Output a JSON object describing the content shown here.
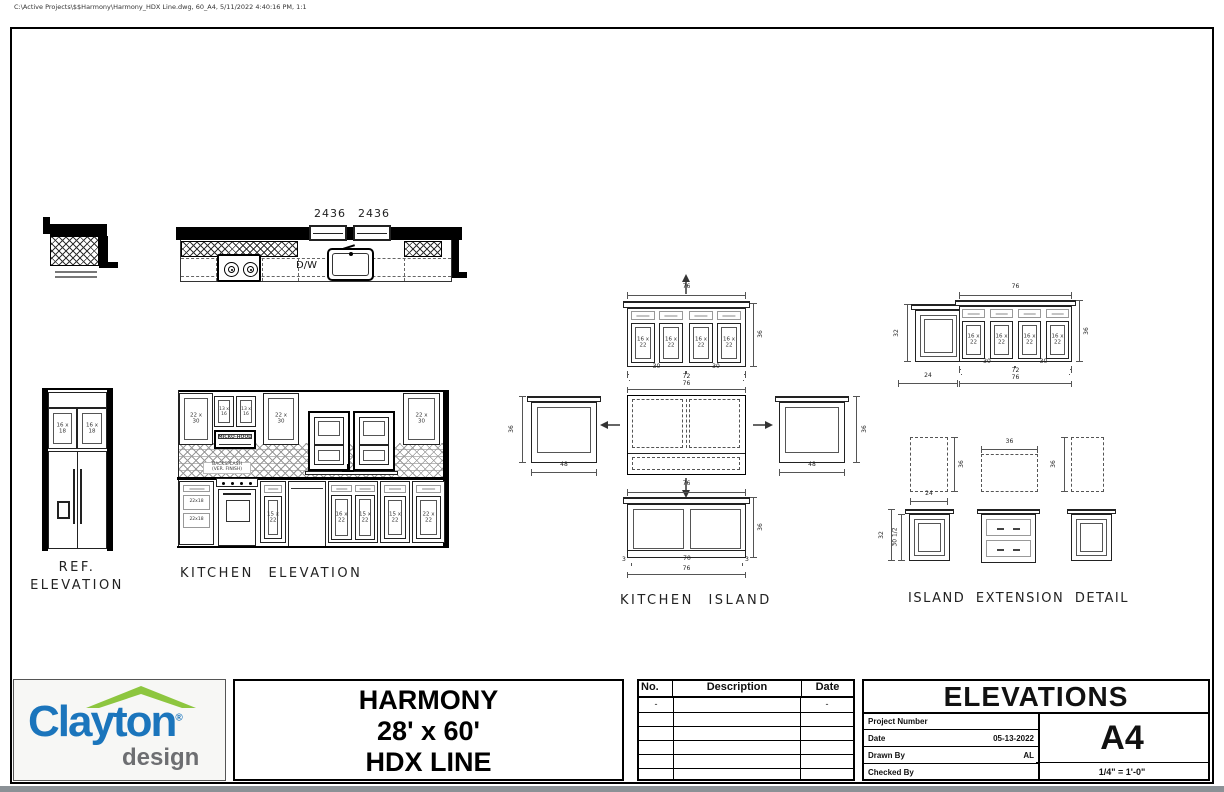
{
  "page": {
    "file_info": "C:\\Active Projects\\$$Harmony\\Harmony_HDX Line.dwg, 60_A4, 5/11/2022 4:40:16 PM, 1:1"
  },
  "colors": {
    "clayton_blue": "#1b75bc",
    "clayton_green": "#8dc63f",
    "design_gray": "#6d6e71"
  },
  "plan": {
    "win1": "2436",
    "win2": "2436",
    "dw": "D/W"
  },
  "ref_elev": {
    "t1": "REF.",
    "t2": "ELEVATION",
    "cab1": "16 x 18",
    "cab2": "16 x 18"
  },
  "kitchen": {
    "title": "KITCHEN ELEVATION",
    "cab_left": "22 x 30",
    "cab_oh1": "13 x 16",
    "cab_oh2": "13 x 16",
    "hood": "MICRO-HOOD",
    "cab_mid": "22 x 30",
    "cab_right": "22 x 30",
    "bs1": "BACKSPLASH",
    "bs2": "(VER. FINISH)",
    "dr1": "22x18",
    "dr2": "22x18",
    "b1": "15 x 22",
    "b2": "16 x 22",
    "b3": "15 x 22",
    "b4": "15 x 22",
    "b5": "22 x 22"
  },
  "island": {
    "title": "KITCHEN ISLAND",
    "d1": "16 x 22",
    "d2": "16 x 22",
    "d3": "16 x 22",
    "d4": "16 x 22",
    "w": "76",
    "h": "36",
    "s30a": "30",
    "s30b": "30",
    "s72": "72",
    "s76": "76",
    "side_h": "36",
    "side_w": "48",
    "back_w": "76",
    "back_h": "36",
    "b3a": "3",
    "b70": "70",
    "b3b": "3",
    "b76": "76"
  },
  "ext": {
    "title": "ISLAND EXTENSION DETAIL",
    "end_h": "32",
    "end_w": "24",
    "w": "76",
    "h": "36",
    "d1": "16 x 22",
    "d2": "16 x 22",
    "d3": "16 x 22",
    "d4": "16 x 22",
    "s30a": "30",
    "s30b": "30",
    "s72": "72",
    "s76": "76",
    "p_left_h": "36",
    "p_left_w": "24",
    "p_mid_w": "36",
    "p_right_h": "36",
    "c_left_d1": "32",
    "c_left_d2": "30 1/2"
  },
  "tb": {
    "brand": "Clayton",
    "reg": "®",
    "brand_sub": "design",
    "m1": "HARMONY",
    "m2": "28' x 60'",
    "m3": "HDX LINE",
    "rev_no": "No.",
    "rev_desc": "Description",
    "rev_date": "Date",
    "rev_r1_no": "-",
    "rev_r1_date": "-",
    "sheet_title": "ELEVATIONS",
    "pn_lbl": "Project Number",
    "date_lbl": "Date",
    "date_val": "05-13-2022",
    "drawn_lbl": "Drawn By",
    "drawn_val": "AL",
    "chk_lbl": "Checked By",
    "sheet_no": "A4",
    "scale": "1/4\" = 1'-0\""
  }
}
